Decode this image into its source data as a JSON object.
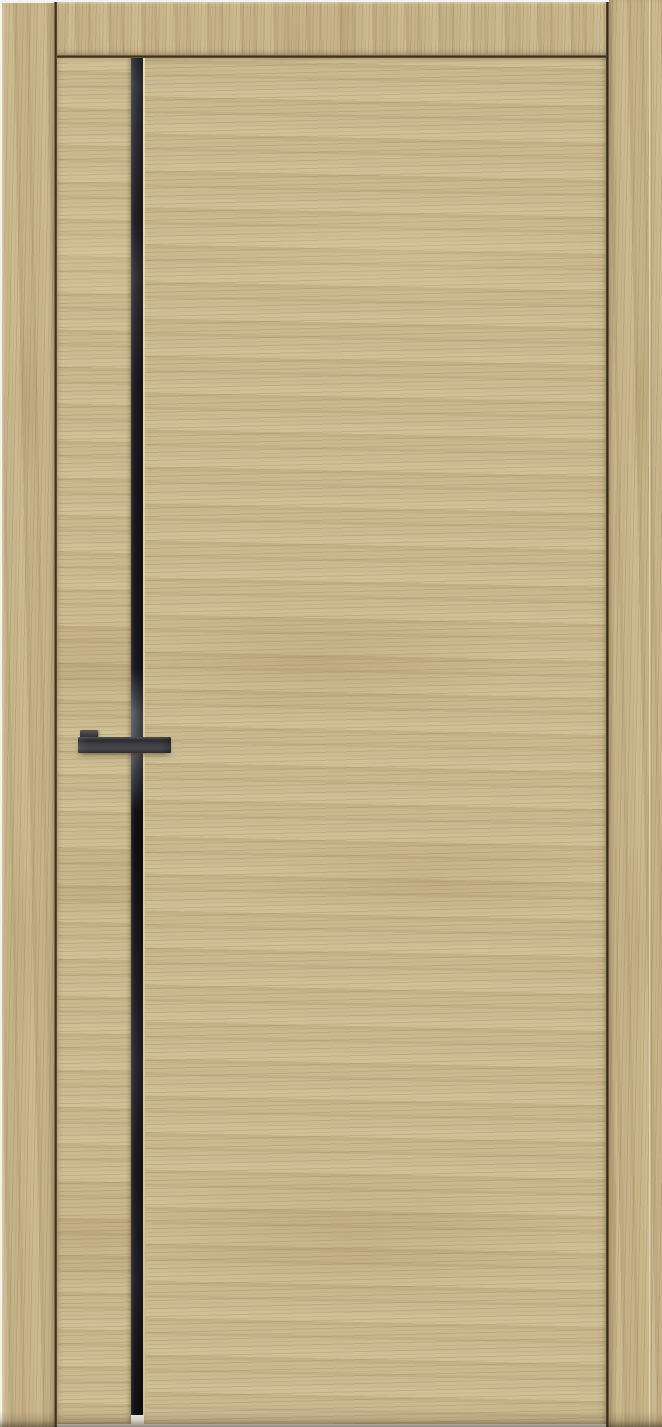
{
  "scene": {
    "description": "Product photo of a closed modern interior door in a light oak woodgrain finish. The door leaf has a slim full-height black glass inlay strip near its left edge with a bright routed highlight line on its right side, and a black rectangular bar lever handle crossing the strip. The leaf is mounted in a matching light oak frame (left casing, top header, right jamb) with thin dark shadow gaps around the leaf.",
    "background_color": "#f4f2ee"
  },
  "door": {
    "parts": {
      "left_frame": "left door frame casing",
      "top_frame": "top door frame header",
      "right_frame": "right door frame jamb",
      "frame_seam": "vertical seam on right jamb",
      "stile": "narrow hinge-side stile of the door leaf",
      "glass_strip": "vertical black glass inlay strip",
      "glass_edge_highlight": "light routed edge line right of the glass strip",
      "panel": "main door leaf panel",
      "handle_mount": "handle mounting block",
      "handle_lever": "black rectangular lever handle",
      "floor_gap": "light floor gap visible below the glass strip",
      "bottom_shade": "floor shadow at the bottom edge"
    },
    "colors": {
      "wood_base": "#cbba90",
      "frame_wood": "#c6b389",
      "wood_grain_dark": "#96794f",
      "wood_grain_light": "#e3d6ae",
      "glass_black": "#1a1b1e",
      "glass_reflection": "#565a61",
      "edge_highlight": "#e9ddb4",
      "handle_graphite": "#3c3c41",
      "gap_dark": "#2e2415",
      "floor_shadow": "#5a4c30",
      "background": "#f4f2ee"
    }
  }
}
